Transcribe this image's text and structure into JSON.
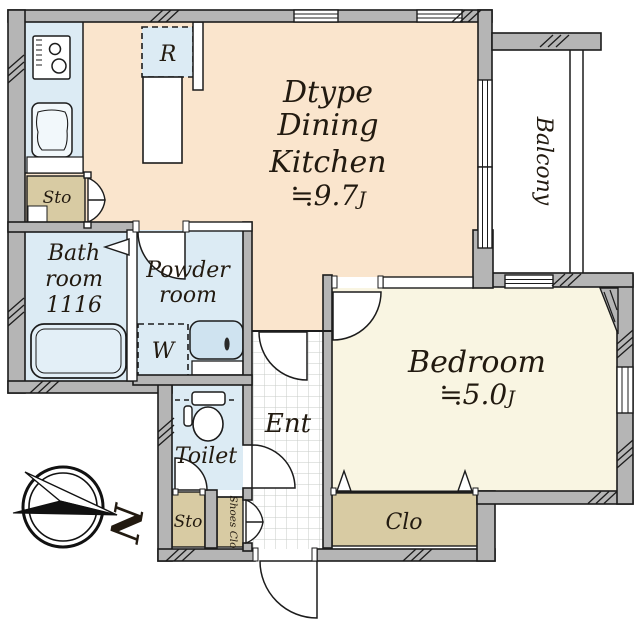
{
  "rooms": {
    "dining_kitchen": {
      "name_lines": [
        "Dtype",
        "Dining",
        "Kitchen"
      ],
      "area": "≒9.7",
      "area_unit": "J"
    },
    "bedroom": {
      "name": "Bedroom",
      "area": "≒5.0",
      "area_unit": "J"
    },
    "balcony": {
      "name": "Balcony"
    },
    "bathroom": {
      "name_lines": [
        "Bath",
        "room",
        "1116"
      ]
    },
    "powder_room": {
      "name_lines": [
        "Powder",
        "room"
      ]
    },
    "toilet": {
      "name": "Toilet"
    },
    "entrance": {
      "name": "Ent"
    },
    "closet": {
      "name": "Clo"
    },
    "storage_kitchen": {
      "name": "Sto"
    },
    "storage_hall": {
      "name": "Sto"
    },
    "shoes_closet": {
      "name": "Shoes Clo"
    }
  },
  "fixtures": {
    "refrigerator": "R",
    "washing_machine": "W"
  },
  "compass": {
    "north": "N"
  },
  "colors": {
    "dk_floor": "#fae5cd",
    "bedroom_floor": "#f9f5e2",
    "wet_room_floor": "#dcebf4",
    "storage_floor": "#d8cba3",
    "wall": "#b5b5b5",
    "line": "#1c1c1c",
    "tile_line": "#c7cbc7"
  }
}
